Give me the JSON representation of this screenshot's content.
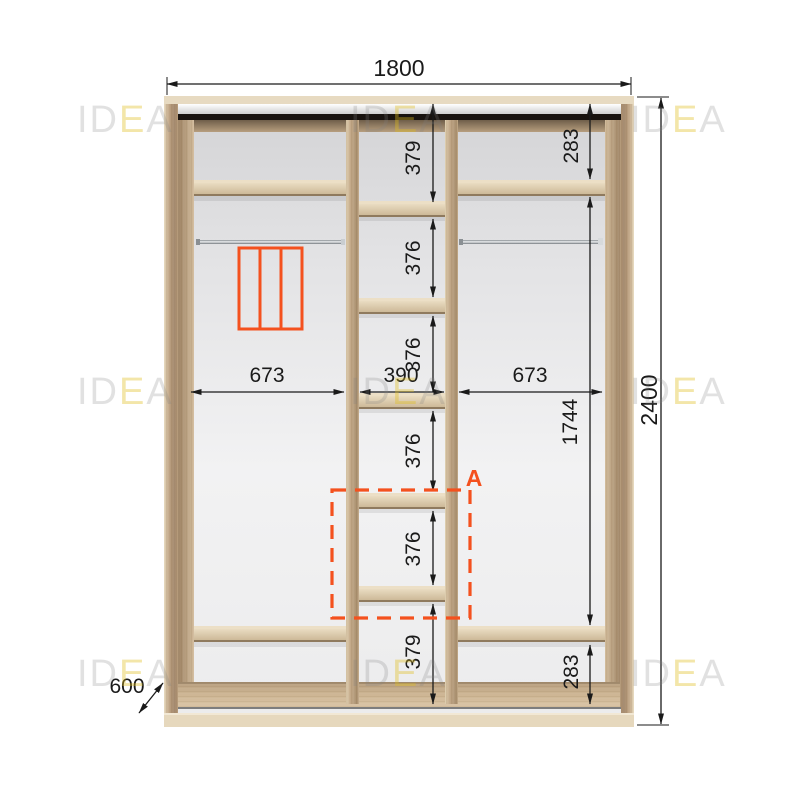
{
  "accent_color": "#F4511E",
  "wood_color": "#d7c6aa",
  "watermark": {
    "part1": "ID",
    "part2": "E",
    "part3": "A"
  },
  "dims": {
    "total_width": "1800",
    "total_height": "2400",
    "depth": "600",
    "left_section_width": "673",
    "middle_section_width": "390",
    "right_section_width": "673",
    "right_inner_height": "1744",
    "right_top_cell": "283",
    "right_bottom_cell": "283",
    "middle_cells": [
      "379",
      "376",
      "376",
      "376",
      "376",
      "379"
    ],
    "detail_label": "A"
  }
}
